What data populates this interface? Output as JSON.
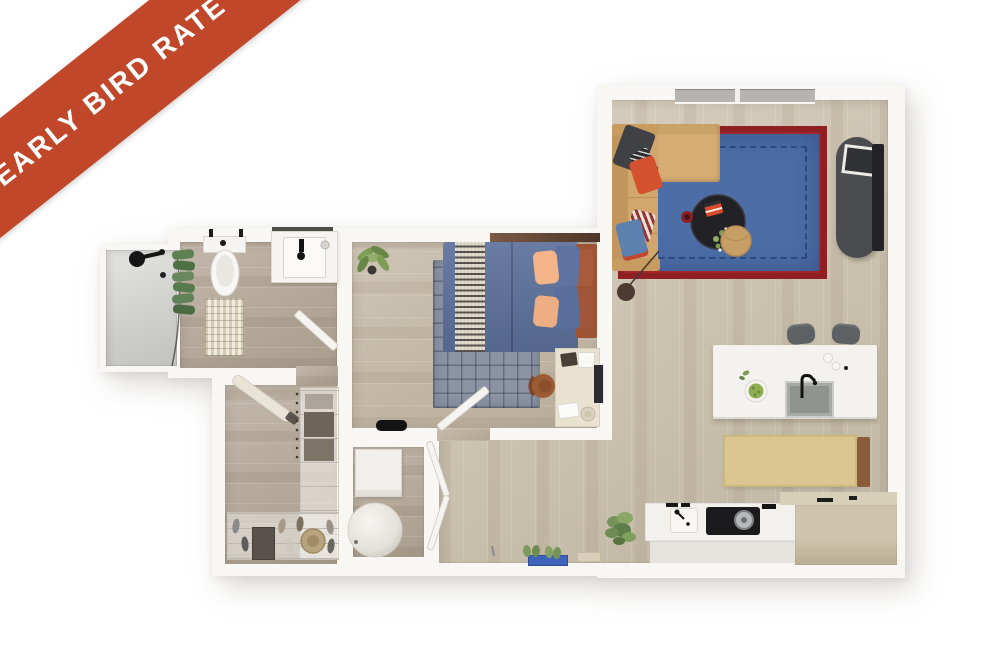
{
  "banner": {
    "label": "EARLY BIRD RATE"
  },
  "palette": {
    "ribbon": "#c04729",
    "wall": "#f8f7f4",
    "floor-living": "#cdc3b1",
    "floor-bedroom": "#c4b9a7",
    "floor-bath": "#b7ab9c",
    "rug-blue": "#4c6da6",
    "rug-border": "#8e2024",
    "sofa-tan": "#d2a76e",
    "bed-blue": "#5b6f99",
    "headboard-rust": "#9c5433",
    "island-white": "#f4f2ef",
    "cabinet-tan": "#c9bea4",
    "stool-gray": "#5d6164",
    "doormat-blue": "#3e63bb"
  }
}
